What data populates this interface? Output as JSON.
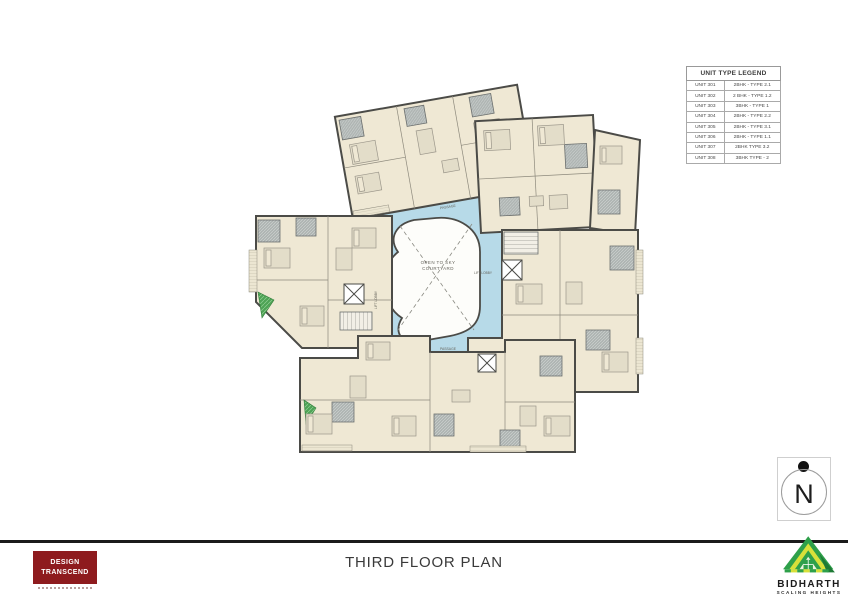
{
  "legend": {
    "title": "UNIT TYPE LEGEND",
    "rows": [
      {
        "unit": "UNIT 301",
        "type": "2BHK - TYPE 2.1"
      },
      {
        "unit": "UNIT 302",
        "type": "2 BHK - TYPE 1.2"
      },
      {
        "unit": "UNIT 303",
        "type": "3BHK - TYPE 1"
      },
      {
        "unit": "UNIT 304",
        "type": "2BHK - TYPE 2.2"
      },
      {
        "unit": "UNIT 305",
        "type": "2BHK - TYPE 3.1"
      },
      {
        "unit": "UNIT 306",
        "type": "2BHK - TYPE 1.1"
      },
      {
        "unit": "UNIT 307",
        "type": "2BHK TYPE 3.2"
      },
      {
        "unit": "UNIT 308",
        "type": "3BHK TYPE - 2"
      }
    ]
  },
  "plan": {
    "courtyard_line1": "OPEN TO SKY",
    "courtyard_line2": "COURTYARD",
    "passage_top": "PASSAGE",
    "passage_bottom": "PASSAGE",
    "lift_lobby_right": "LIFT LOBBY",
    "lift_lobby_left": "LIFT LOBBY"
  },
  "north": {
    "label": "N"
  },
  "footer": {
    "title": "THIRD FLOOR PLAN"
  },
  "design_logo": {
    "line1": "DESIGN",
    "line2": "TRANSCEND"
  },
  "builder_logo": {
    "name": "BIDHARTH",
    "tagline": "SCALING HEIGHTS"
  },
  "colors": {
    "room_fill": "#efe8d4",
    "wall": "#4b4b47",
    "corridor_blue": "#b7dae8",
    "bathroom_gray": "#aeb4b2",
    "courtyard_white": "#fdfdfa",
    "logo_maroon": "#8e1b1e",
    "logo_green": "#2ea04a",
    "logo_yellow": "#d8e03a"
  }
}
